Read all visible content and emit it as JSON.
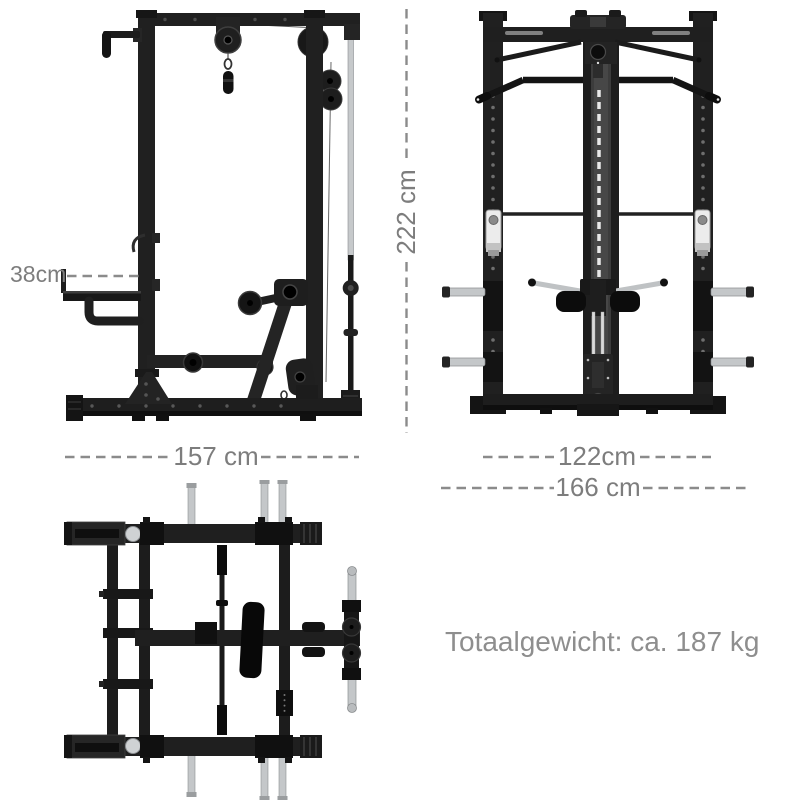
{
  "annotations": {
    "seat_height": {
      "label": "38cm"
    },
    "total_height": {
      "label": "222 cm"
    },
    "depth": {
      "label": "157 cm"
    },
    "inner_width": {
      "label": "122cm"
    },
    "outer_width": {
      "label": "166 cm"
    },
    "weight": {
      "label": "Totaalgewicht: ca. 187 kg"
    }
  },
  "colors": {
    "background": "#ffffff",
    "frame_black": "#1f1f1f",
    "chrome": "#c4c7c9",
    "annotation_text": "#7d7d7d",
    "dash_line": "#8b8b8b"
  }
}
